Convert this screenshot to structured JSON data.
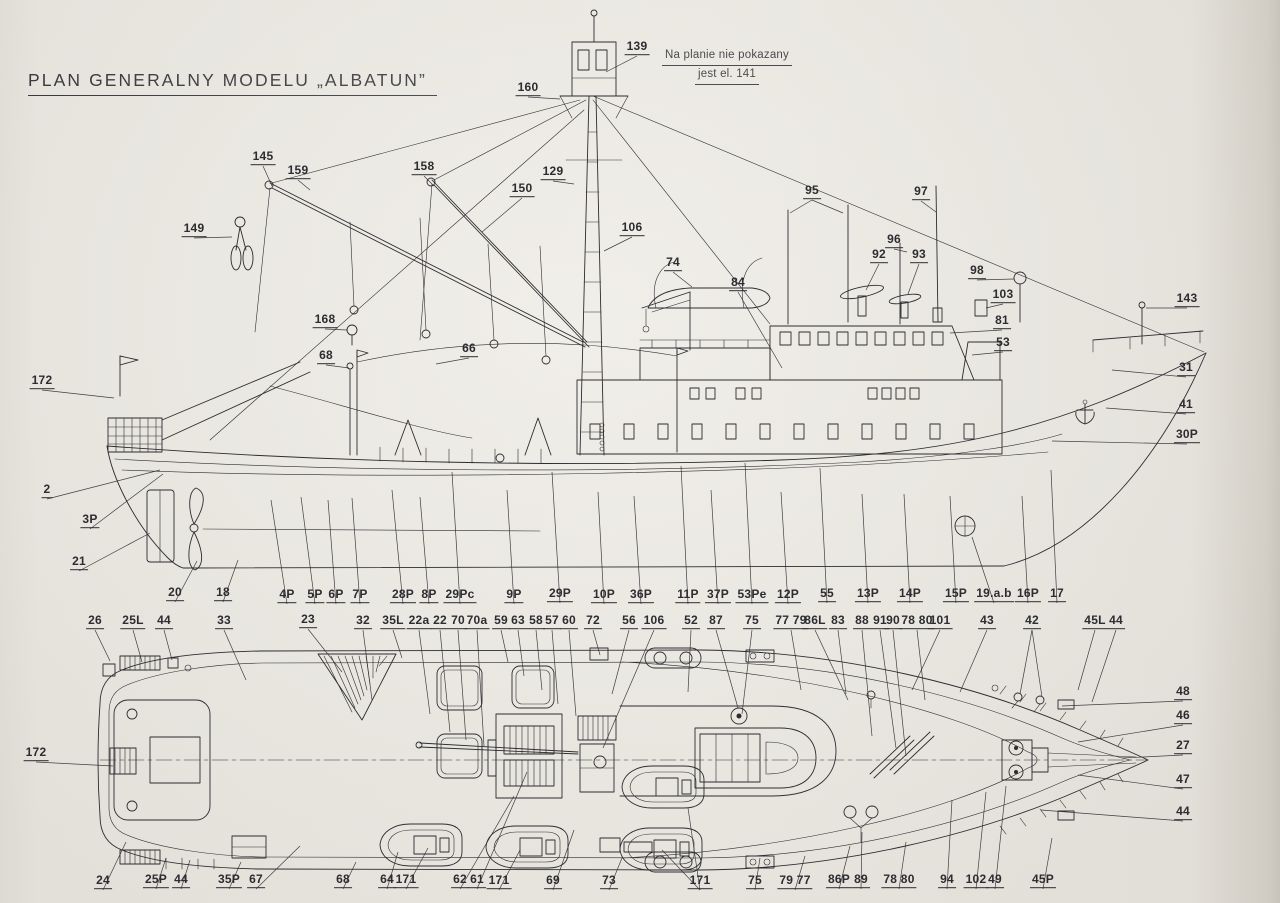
{
  "page": {
    "title": "PLAN GENERALNY MODELU „ALBATUN”",
    "paper_color": "#eae7e0",
    "ink_color": "#2c2c31"
  },
  "note": {
    "line1": "Na planie nie pokazany",
    "line2": "jest el. 141"
  },
  "side_view": {
    "name": "side-profile-view",
    "labels": [
      {
        "t": "139",
        "x": 637,
        "y": 48,
        "lx": 606,
        "ly": 72
      },
      {
        "t": "160",
        "x": 528,
        "y": 89,
        "lx": 560,
        "ly": 99
      },
      {
        "t": "145",
        "x": 263,
        "y": 158,
        "lx": 272,
        "ly": 186
      },
      {
        "t": "159",
        "x": 298,
        "y": 172,
        "lx": 310,
        "ly": 190
      },
      {
        "t": "158",
        "x": 424,
        "y": 168,
        "lx": 434,
        "ly": 186
      },
      {
        "t": "150",
        "x": 522,
        "y": 190,
        "lx": 482,
        "ly": 232
      },
      {
        "t": "129",
        "x": 553,
        "y": 173,
        "lx": 574,
        "ly": 184
      },
      {
        "t": "149",
        "x": 194,
        "y": 230,
        "lx": 232,
        "ly": 237
      },
      {
        "t": "106",
        "x": 632,
        "y": 229,
        "lx": 604,
        "ly": 251
      },
      {
        "t": "168",
        "x": 325,
        "y": 321,
        "lx": 347,
        "ly": 330
      },
      {
        "t": "74",
        "x": 673,
        "y": 264,
        "lx": 692,
        "ly": 287
      },
      {
        "t": "84",
        "x": 738,
        "y": 284,
        "lx": 782,
        "ly": 368
      },
      {
        "t": "95",
        "x": 812,
        "y": 192,
        "lx": 790,
        "ly": 213,
        "lx2": 843,
        "ly2": 213
      },
      {
        "t": "97",
        "x": 921,
        "y": 193,
        "lx": 936,
        "ly": 212
      },
      {
        "t": "96",
        "x": 894,
        "y": 241,
        "lx": 907,
        "ly": 252
      },
      {
        "t": "92",
        "x": 879,
        "y": 256,
        "lx": 866,
        "ly": 290
      },
      {
        "t": "93",
        "x": 919,
        "y": 256,
        "lx": 908,
        "ly": 294
      },
      {
        "t": "98",
        "x": 977,
        "y": 272,
        "lx": 1014,
        "ly": 279
      },
      {
        "t": "103",
        "x": 1003,
        "y": 296,
        "lx": 986,
        "ly": 308
      },
      {
        "t": "81",
        "x": 1002,
        "y": 322,
        "lx": 950,
        "ly": 333
      },
      {
        "t": "53",
        "x": 1003,
        "y": 344,
        "lx": 972,
        "ly": 355
      },
      {
        "t": "143",
        "x": 1187,
        "y": 300,
        "lx": 1146,
        "ly": 308
      },
      {
        "t": "31",
        "x": 1186,
        "y": 369,
        "lx": 1112,
        "ly": 370
      },
      {
        "t": "41",
        "x": 1186,
        "y": 406,
        "lx": 1106,
        "ly": 408
      },
      {
        "t": "30P",
        "x": 1187,
        "y": 436,
        "lx": 1052,
        "ly": 441
      },
      {
        "t": "172",
        "x": 42,
        "y": 382,
        "lx": 114,
        "ly": 398
      },
      {
        "t": "68",
        "x": 326,
        "y": 357,
        "lx": 349,
        "ly": 368
      },
      {
        "t": "66",
        "x": 469,
        "y": 350,
        "lx": 436,
        "ly": 364
      },
      {
        "t": "2",
        "x": 47,
        "y": 491,
        "lx": 160,
        "ly": 470
      },
      {
        "t": "3P",
        "x": 90,
        "y": 521,
        "lx": 163,
        "ly": 474
      },
      {
        "t": "21",
        "x": 79,
        "y": 563,
        "lx": 150,
        "ly": 533
      },
      {
        "t": "20",
        "x": 175,
        "y": 594,
        "lx": 197,
        "ly": 561
      },
      {
        "t": "18",
        "x": 223,
        "y": 594,
        "lx": 238,
        "ly": 560
      },
      {
        "t": "4P",
        "x": 287,
        "y": 596,
        "lx": 271,
        "ly": 500
      },
      {
        "t": "5P",
        "x": 315,
        "y": 596,
        "lx": 301,
        "ly": 497
      },
      {
        "t": "6P",
        "x": 336,
        "y": 596,
        "lx": 328,
        "ly": 500
      },
      {
        "t": "7P",
        "x": 360,
        "y": 596,
        "lx": 352,
        "ly": 498
      },
      {
        "t": "28P",
        "x": 403,
        "y": 596,
        "lx": 392,
        "ly": 490
      },
      {
        "t": "8P",
        "x": 429,
        "y": 596,
        "lx": 420,
        "ly": 497
      },
      {
        "t": "29Pc",
        "x": 460,
        "y": 596,
        "lx": 452,
        "ly": 472
      },
      {
        "t": "9P",
        "x": 514,
        "y": 596,
        "lx": 507,
        "ly": 490
      },
      {
        "t": "29P",
        "x": 560,
        "y": 595,
        "lx": 552,
        "ly": 472
      },
      {
        "t": "10P",
        "x": 604,
        "y": 596,
        "lx": 598,
        "ly": 492
      },
      {
        "t": "36P",
        "x": 641,
        "y": 596,
        "lx": 634,
        "ly": 496
      },
      {
        "t": "11P",
        "x": 688,
        "y": 596,
        "lx": 681,
        "ly": 466
      },
      {
        "t": "37P",
        "x": 718,
        "y": 596,
        "lx": 711,
        "ly": 490
      },
      {
        "t": "53Pe",
        "x": 752,
        "y": 596,
        "lx": 745,
        "ly": 463
      },
      {
        "t": "12P",
        "x": 788,
        "y": 596,
        "lx": 781,
        "ly": 492
      },
      {
        "t": "55",
        "x": 827,
        "y": 595,
        "lx": 820,
        "ly": 468
      },
      {
        "t": "13P",
        "x": 868,
        "y": 595,
        "lx": 862,
        "ly": 494
      },
      {
        "t": "14P",
        "x": 910,
        "y": 595,
        "lx": 904,
        "ly": 494
      },
      {
        "t": "15P",
        "x": 956,
        "y": 595,
        "lx": 950,
        "ly": 496
      },
      {
        "t": "19.a.b",
        "x": 994,
        "y": 595,
        "lx": 972,
        "ly": 537
      },
      {
        "t": "16P",
        "x": 1028,
        "y": 595,
        "lx": 1022,
        "ly": 496
      },
      {
        "t": "17",
        "x": 1057,
        "y": 595,
        "lx": 1051,
        "ly": 470
      }
    ]
  },
  "deck_view": {
    "name": "deck-plan-view",
    "labels": [
      {
        "t": "26",
        "x": 95,
        "y": 622,
        "lx": 110,
        "ly": 661
      },
      {
        "t": "25L",
        "x": 133,
        "y": 622,
        "lx": 142,
        "ly": 662
      },
      {
        "t": "44",
        "x": 164,
        "y": 622,
        "lx": 172,
        "ly": 660
      },
      {
        "t": "33",
        "x": 224,
        "y": 622,
        "lx": 246,
        "ly": 680
      },
      {
        "t": "23",
        "x": 308,
        "y": 621,
        "lx": 342,
        "ly": 672
      },
      {
        "t": "32",
        "x": 363,
        "y": 622,
        "lx": 372,
        "ly": 700
      },
      {
        "t": "35L",
        "x": 393,
        "y": 622,
        "lx": 402,
        "ly": 658
      },
      {
        "t": "22a",
        "x": 419,
        "y": 622,
        "lx": 430,
        "ly": 714
      },
      {
        "t": "22",
        "x": 440,
        "y": 622,
        "lx": 450,
        "ly": 732
      },
      {
        "t": "70",
        "x": 458,
        "y": 622,
        "lx": 466,
        "ly": 740
      },
      {
        "t": "70a",
        "x": 477,
        "y": 622,
        "lx": 484,
        "ly": 746
      },
      {
        "t": "59",
        "x": 501,
        "y": 622,
        "lx": 508,
        "ly": 662
      },
      {
        "t": "63",
        "x": 518,
        "y": 622,
        "lx": 524,
        "ly": 676
      },
      {
        "t": "58",
        "x": 536,
        "y": 622,
        "lx": 542,
        "ly": 690
      },
      {
        "t": "57",
        "x": 552,
        "y": 622,
        "lx": 558,
        "ly": 704
      },
      {
        "t": "60",
        "x": 569,
        "y": 622,
        "lx": 576,
        "ly": 716
      },
      {
        "t": "72",
        "x": 593,
        "y": 622,
        "lx": 600,
        "ly": 655
      },
      {
        "t": "56",
        "x": 629,
        "y": 622,
        "lx": 612,
        "ly": 694
      },
      {
        "t": "106",
        "x": 654,
        "y": 622,
        "lx": 603,
        "ly": 748
      },
      {
        "t": "52",
        "x": 691,
        "y": 622,
        "lx": 688,
        "ly": 692
      },
      {
        "t": "87",
        "x": 716,
        "y": 622,
        "lx": 738,
        "ly": 708
      },
      {
        "t": "75",
        "x": 752,
        "y": 622,
        "lx": 742,
        "ly": 714
      },
      {
        "t": "77 79",
        "x": 791,
        "y": 622,
        "lx": 801,
        "ly": 690
      },
      {
        "t": "86L",
        "x": 815,
        "y": 622,
        "lx": 848,
        "ly": 700
      },
      {
        "t": "83",
        "x": 838,
        "y": 622,
        "lx": 846,
        "ly": 694
      },
      {
        "t": "88",
        "x": 862,
        "y": 622,
        "lx": 872,
        "ly": 736
      },
      {
        "t": "91",
        "x": 880,
        "y": 622,
        "lx": 896,
        "ly": 748
      },
      {
        "t": "90",
        "x": 893,
        "y": 622,
        "lx": 906,
        "ly": 756
      },
      {
        "t": "78 80",
        "x": 917,
        "y": 622,
        "lx": 925,
        "ly": 700
      },
      {
        "t": "101",
        "x": 940,
        "y": 622,
        "lx": 912,
        "ly": 690
      },
      {
        "t": "43",
        "x": 987,
        "y": 622,
        "lx": 960,
        "ly": 692
      },
      {
        "t": "42",
        "x": 1032,
        "y": 622,
        "lx": 1020,
        "ly": 694,
        "lx2": 1042,
        "ly2": 697
      },
      {
        "t": "45L",
        "x": 1095,
        "y": 622,
        "lx": 1078,
        "ly": 690
      },
      {
        "t": "44",
        "x": 1116,
        "y": 622,
        "lx": 1092,
        "ly": 702
      },
      {
        "t": "48",
        "x": 1183,
        "y": 693,
        "lx": 1062,
        "ly": 706
      },
      {
        "t": "46",
        "x": 1183,
        "y": 717,
        "lx": 1078,
        "ly": 742
      },
      {
        "t": "27",
        "x": 1183,
        "y": 747,
        "lx": 1122,
        "ly": 758
      },
      {
        "t": "47",
        "x": 1183,
        "y": 781,
        "lx": 1078,
        "ly": 775
      },
      {
        "t": "44",
        "x": 1183,
        "y": 813,
        "lx": 1041,
        "ly": 810
      },
      {
        "t": "172",
        "x": 36,
        "y": 754,
        "lx": 113,
        "ly": 766
      },
      {
        "t": "24",
        "x": 103,
        "y": 882,
        "lx": 126,
        "ly": 842
      },
      {
        "t": "25P",
        "x": 156,
        "y": 881,
        "lx": 166,
        "ly": 858
      },
      {
        "t": "44",
        "x": 181,
        "y": 881,
        "lx": 190,
        "ly": 860
      },
      {
        "t": "35P",
        "x": 229,
        "y": 881,
        "lx": 241,
        "ly": 862
      },
      {
        "t": "67",
        "x": 256,
        "y": 881,
        "lx": 300,
        "ly": 846
      },
      {
        "t": "68",
        "x": 343,
        "y": 881,
        "lx": 356,
        "ly": 862
      },
      {
        "t": "64",
        "x": 387,
        "y": 881,
        "lx": 398,
        "ly": 852
      },
      {
        "t": "171",
        "x": 406,
        "y": 881,
        "lx": 428,
        "ly": 848
      },
      {
        "t": "62",
        "x": 460,
        "y": 881,
        "lx": 514,
        "ly": 796
      },
      {
        "t": "61",
        "x": 477,
        "y": 881,
        "lx": 527,
        "ly": 772
      },
      {
        "t": "171",
        "x": 499,
        "y": 882,
        "lx": 520,
        "ly": 850
      },
      {
        "t": "69",
        "x": 553,
        "y": 882,
        "lx": 574,
        "ly": 830
      },
      {
        "t": "73",
        "x": 609,
        "y": 882,
        "lx": 622,
        "ly": 858
      },
      {
        "t": "171",
        "x": 700,
        "y": 882,
        "lx": 662,
        "ly": 850,
        "lx2": 688,
        "ly2": 808
      },
      {
        "t": "75",
        "x": 755,
        "y": 882,
        "lx": 760,
        "ly": 858
      },
      {
        "t": "79 77",
        "x": 795,
        "y": 882,
        "lx": 805,
        "ly": 856
      },
      {
        "t": "86P",
        "x": 839,
        "y": 881,
        "lx": 850,
        "ly": 846
      },
      {
        "t": "89",
        "x": 861,
        "y": 881,
        "lx": 862,
        "ly": 832
      },
      {
        "t": "78 80",
        "x": 899,
        "y": 881,
        "lx": 906,
        "ly": 842
      },
      {
        "t": "94",
        "x": 947,
        "y": 881,
        "lx": 952,
        "ly": 800
      },
      {
        "t": "102",
        "x": 976,
        "y": 881,
        "lx": 986,
        "ly": 792
      },
      {
        "t": "49",
        "x": 995,
        "y": 881,
        "lx": 1006,
        "ly": 786
      },
      {
        "t": "45P",
        "x": 1043,
        "y": 881,
        "lx": 1052,
        "ly": 838
      }
    ]
  }
}
